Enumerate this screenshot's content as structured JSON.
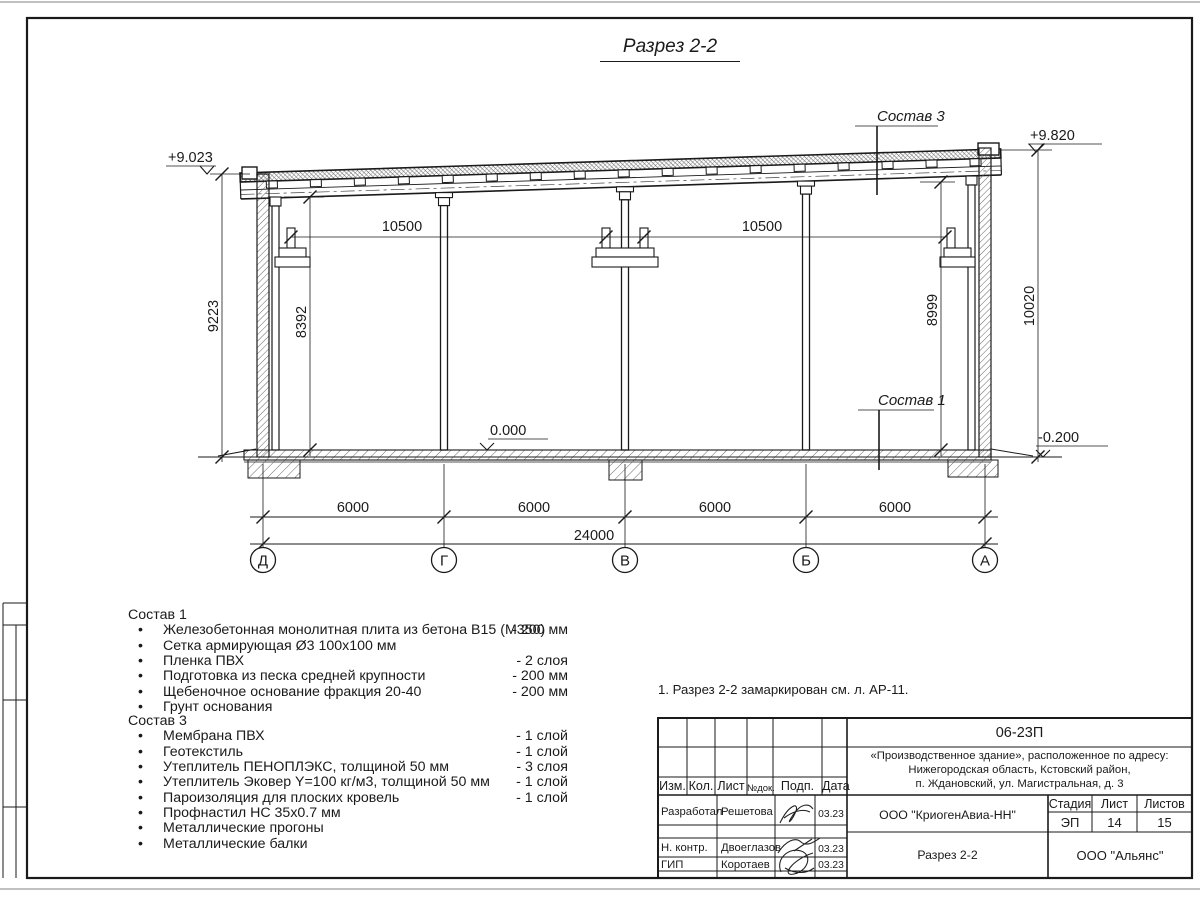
{
  "sheet": {
    "title": "Разрез 2-2",
    "note": "1. Разрез 2-2 замаркирован см. л. АР-11."
  },
  "colors": {
    "line": "#1a1a1a",
    "paper": "#ffffff"
  },
  "ui": {
    "bullet": "•"
  },
  "drawing": {
    "elev_top_left": "+9.023",
    "elev_top_right": "+9.820",
    "elev_floor": "0.000",
    "elev_ground": "-0.200",
    "dim_crane_left": "10500",
    "dim_crane_right": "10500",
    "dim_left_outer": "9223",
    "dim_left_inner": "8392",
    "dim_right_inner": "8999",
    "dim_right_outer": "10020",
    "bay_1": "6000",
    "bay_2": "6000",
    "bay_3": "6000",
    "bay_4": "6000",
    "dim_total": "24000",
    "axis_1": "Д",
    "axis_2": "Г",
    "axis_3": "В",
    "axis_4": "Б",
    "axis_5": "А",
    "callout_roof": "Состав 3",
    "callout_floor": "Состав 1"
  },
  "composition1": {
    "title": "Состав 1",
    "items": [
      {
        "text": "Железобетонная монолитная плита из бетона В15 (М350)",
        "value": "-  200 мм"
      },
      {
        "text": "Сетка армирующая Ø3 100х100 мм",
        "value": ""
      },
      {
        "text": "Пленка ПВХ",
        "value": "-  2 слоя"
      },
      {
        "text": "Подготовка из песка средней крупности",
        "value": "- 200 мм"
      },
      {
        "text": "Щебеночное основание фракция 20-40",
        "value": "- 200 мм"
      },
      {
        "text": "Грунт основания",
        "value": ""
      }
    ]
  },
  "composition3": {
    "title": "Состав 3",
    "items": [
      {
        "text": "Мембрана ПВХ",
        "value": "- 1 слой"
      },
      {
        "text": "Геотекстиль",
        "value": "- 1 слой"
      },
      {
        "text": "Утеплитель ПЕНОПЛЭКС, толщиной 50 мм",
        "value": "- 3 слоя"
      },
      {
        "text": "Утеплитель Эковер Y=100 кг/м3, толщиной 50 мм",
        "value": "- 1 слой"
      },
      {
        "text": "Пароизоляция для плоских кровель",
        "value": "- 1 слой"
      },
      {
        "text": "Профнастил НС 35х0.7 мм",
        "value": ""
      },
      {
        "text": "Металлические прогоны",
        "value": ""
      },
      {
        "text": "Металлические балки",
        "value": ""
      }
    ]
  },
  "titleblock": {
    "doc_number": "06-23П",
    "project_line1": "«Производственное здание», расположенное по адресу:",
    "project_line2": "Нижегородская область, Кстовский район,",
    "project_line3": "п. Ждановский, ул. Магистральная, д. 3",
    "col_izm": "Изм.",
    "col_kol": "Кол.",
    "col_list": "Лист",
    "col_ndok": "№док.",
    "col_podp": "Подп.",
    "col_data": "Дата",
    "row1_role": "Разработал",
    "row1_name": "Решетова",
    "row1_date": "03.23",
    "row2_role": "Н. контр.",
    "row2_name": "Двоеглазов",
    "row2_date": "03.23",
    "row3_role": "ГИП",
    "row3_name": "Коротаев",
    "row3_date": "03.23",
    "org": "ООО \"КриогенАвиа-НН\"",
    "stage_label": "Стадия",
    "sheet_label": "Лист",
    "sheets_label": "Листов",
    "stage": "ЭП",
    "sheet_no": "14",
    "sheets_total": "15",
    "drawing_name": "Разрез 2-2",
    "contractor": "ООО \"Альянс\""
  }
}
